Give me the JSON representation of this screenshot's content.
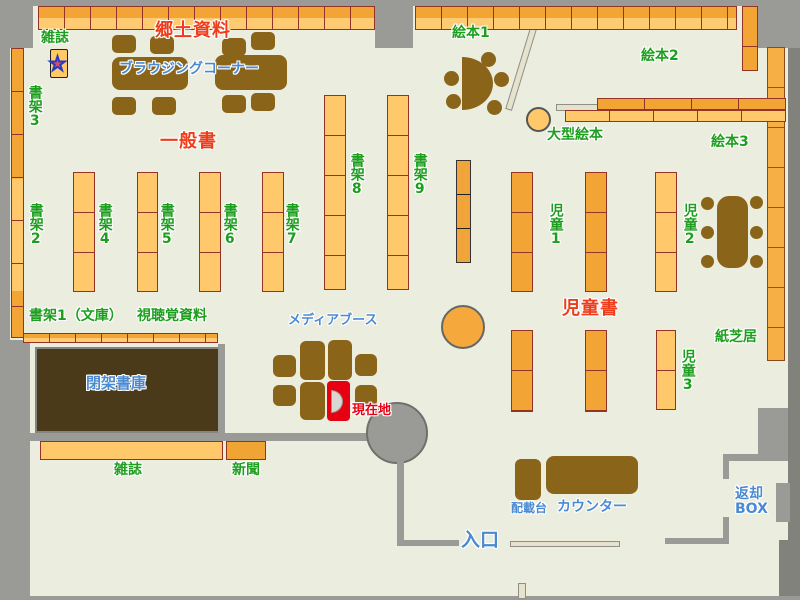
{
  "colors": {
    "floor": "#ebeddf",
    "wall_gray": "#9a9a96",
    "shelf_light_orange": "#ffc96b",
    "shelf_dark_orange": "#f2a435",
    "shelf_border": "#943426",
    "furniture_brown": "#8a6418",
    "closed_stacks_brown": "#4a3a1a",
    "label_green": "#1e9e1e",
    "label_red": "#ee3d1c",
    "label_blue": "#4a8ad2",
    "current_location_red": "#e60012"
  },
  "icons": {
    "magazine_star_glyph": "★"
  },
  "labels": {
    "magazines_top": "雑誌",
    "local_materials": "郷土資料",
    "browsing_corner": "ブラウジングコーナー",
    "general_books": "一般書",
    "shelf2": "書架2",
    "shelf3": "書架3",
    "shelf4": "書架4",
    "shelf5": "書架5",
    "shelf6": "書架6",
    "shelf7": "書架7",
    "shelf8": "書架8",
    "shelf9": "書架9",
    "shelf1_bunko": "書架1（文庫）",
    "audio_visual": "視聴覚資料",
    "picture_books1": "絵本1",
    "picture_books2": "絵本2",
    "picture_books3": "絵本3",
    "large_picture_books": "大型絵本",
    "children1": "児童1",
    "children2": "児童2",
    "children3": "児童3",
    "children_books": "児童書",
    "kamishibai": "紙芝居",
    "media_booth": "メディアブース",
    "closed_stacks": "閉架書庫",
    "current_location": "現在地",
    "magazines_bottom": "雑誌",
    "newspapers": "新聞",
    "loading_table": "配載台",
    "counter": "カウンター",
    "entrance": "入口",
    "return_box": "返却BOX"
  }
}
